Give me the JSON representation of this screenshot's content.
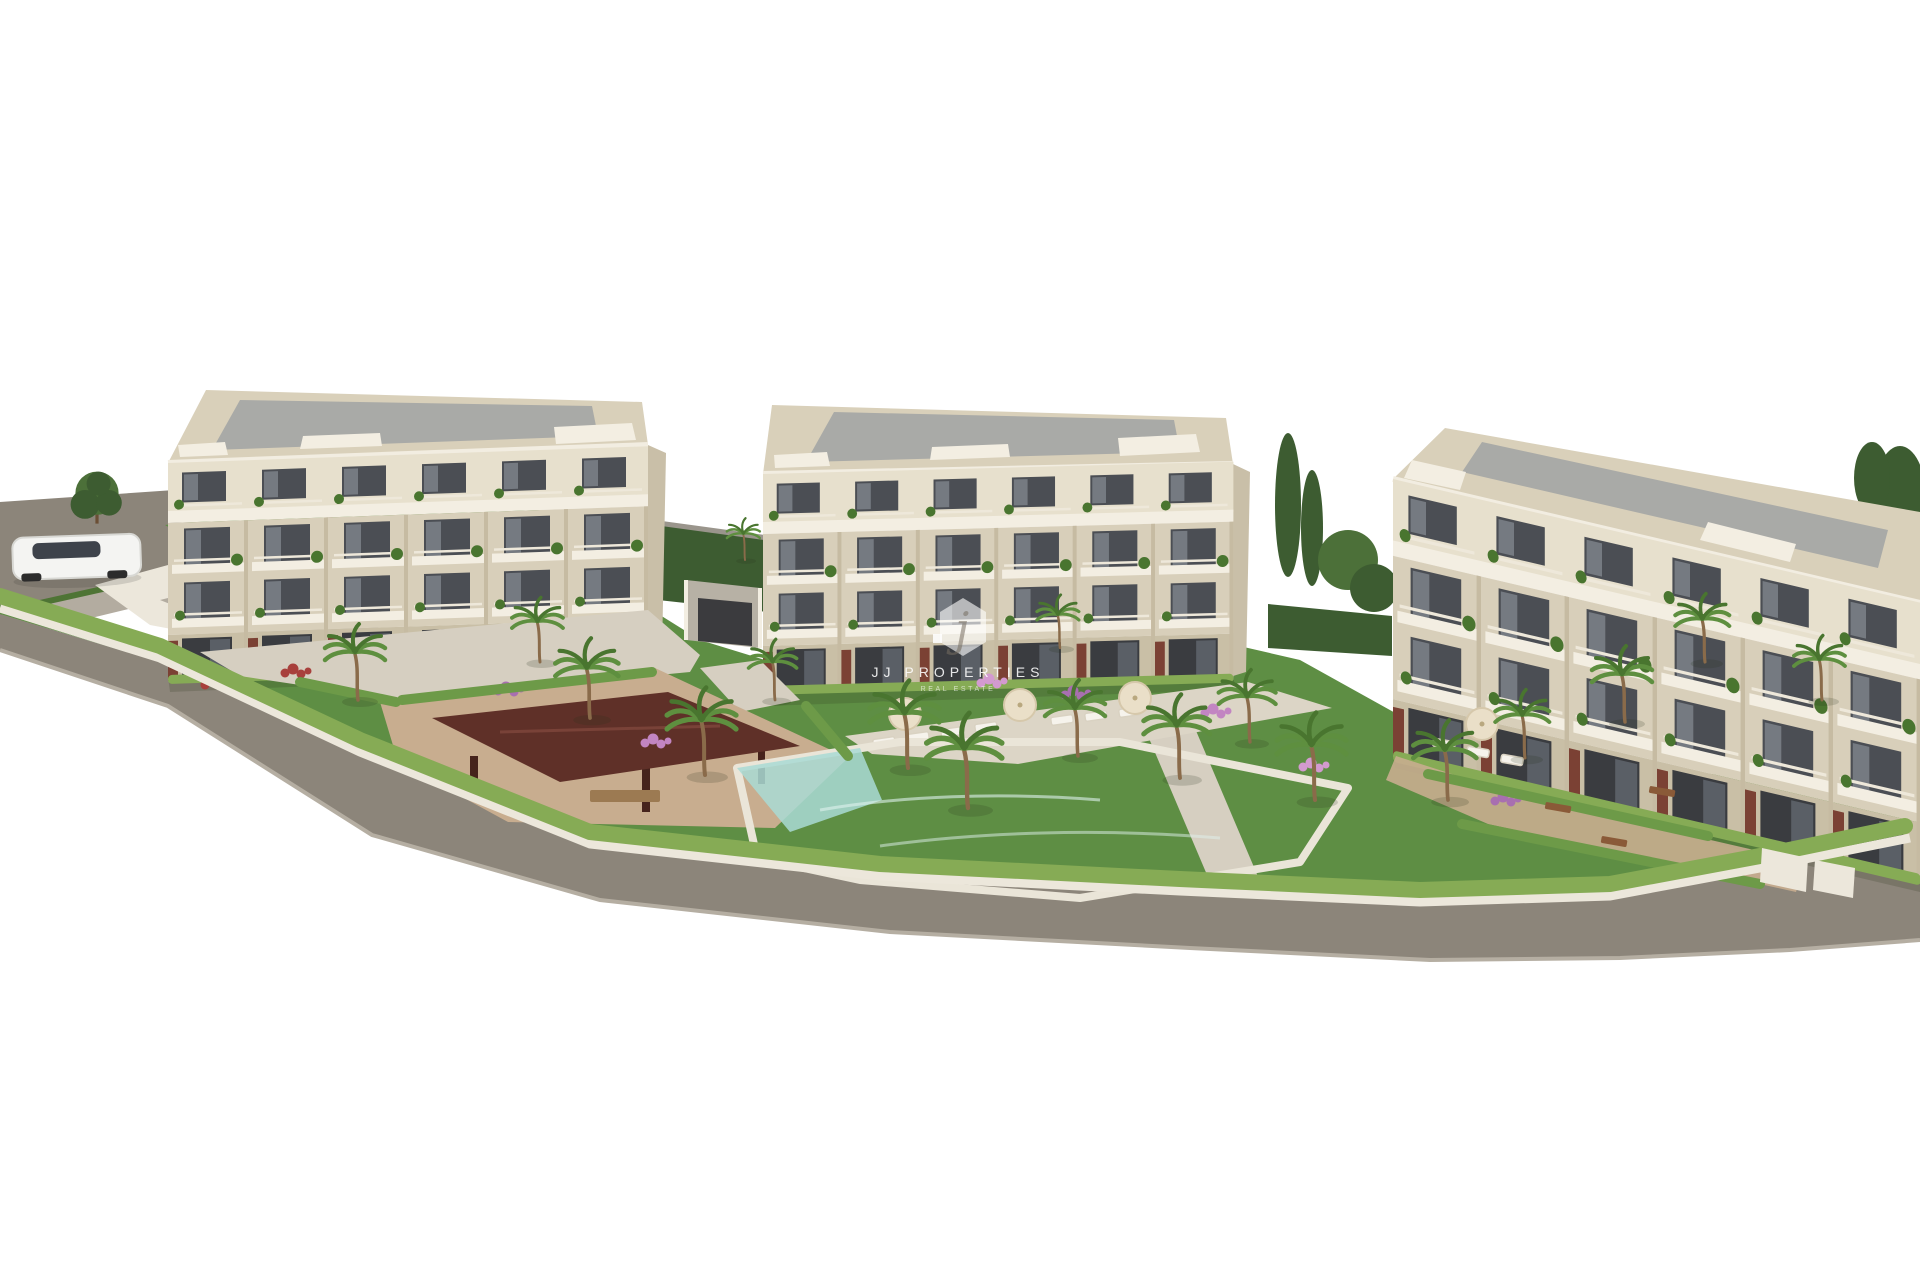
{
  "image": {
    "type": "3d-architectural-render",
    "description": "Aerial 3D visualisation of a new-build residential complex: three cream four-storey apartment buildings with grey flat roofs and balconies, landscaped gardens with palm trees and hedges, a turquoise communal swimming pool with sun loungers and parasols, a dark-red wooden gazebo, perimeter streets with a white car, all on a white background",
    "background_color": "#ffffff"
  },
  "watermark": {
    "logo_letter": "j",
    "brand": "JJ PROPERTIES",
    "tagline": "REAL ESTATE"
  },
  "scene_inventory": {
    "apartment_buildings": 3,
    "swimming_pools": 1,
    "gazebos": 1,
    "cars": 1,
    "palm_trees": 18,
    "sun_loungers": 10,
    "parasols": 4,
    "garden_benches": 3
  },
  "colors": {
    "facade": "#d8cfba",
    "facade_light": "#e7e0cd",
    "facade_dark": "#c9bfa6",
    "slab": "#f3eee2",
    "window": "#4b4e54",
    "window_dark": "#3a3c40",
    "glass": "#7d828a",
    "roof_frame": "#d9d0ba",
    "roof_panel": "#a9aaa7",
    "accent_panel": "#7b4134",
    "grass": "#5e8e44",
    "hedge": "#86ab55",
    "road": "#8c857a",
    "sidewalk": "#b3aca0",
    "path": "#d6cfc1",
    "sand": "#c8ad8f",
    "pool": "#6fc2c0",
    "gazebo_roof": "#5f3028",
    "tree": "#4c7039",
    "trunk": "#8a6b4a",
    "car_body": "#f4f4f2"
  }
}
